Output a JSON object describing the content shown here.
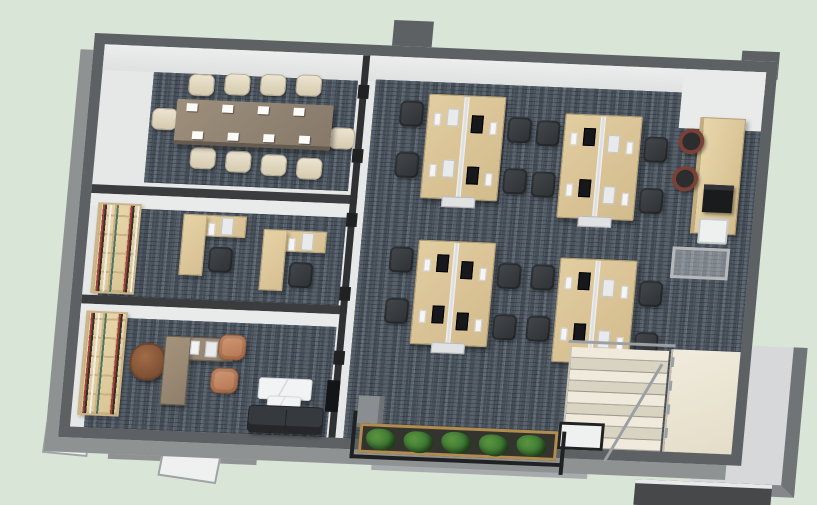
{
  "app": {
    "type": "3d-floorplan-render",
    "view": "axonometric top-down",
    "subject": "office interior with meeting room, private offices, open workspace, pantry and stairwell"
  },
  "colors": {
    "background": "#d9e5d7",
    "wallCap": "#5e6163",
    "wallOuter": "#8f9293",
    "wallDark": "#3a3c3e",
    "floorWhite": "#e6e7e7",
    "faceWhite": "#eceeee",
    "carpet": "#4d5660",
    "wood": "#e0cba0",
    "woodDeep": "#cbb488",
    "tableWalnut": "#93846f",
    "cream": "#e7dfcb",
    "chairDark": "#3a3d41",
    "monitorDark": "#17181c",
    "monitorLight": "#e8eaeb",
    "execBrown": "#8a5a3d",
    "guestTan": "#c48a66",
    "sofa": "#36393d",
    "marble": "#f2f3f4",
    "stoolTop": "#2b2d2f",
    "stoolRing": "#7b4036",
    "plantGreen": "#3e7a33",
    "soil": "#33342e",
    "planterWood": "#b28b4e",
    "tileBeige": "#ebe5d3",
    "stepLight": "#efeadb",
    "stepShade": "#d9d3c2",
    "railMetal": "#9aa0a4",
    "frameBlack": "#1f2123",
    "glassWhite": "#eff1f0",
    "parapetGray": "#a8abad",
    "ledgeTan": "#cdbf9f"
  },
  "scene": {
    "rooms": [
      {
        "id": "conference-room",
        "label": "Conference room",
        "items": [
          "walnut conference table",
          "10 cream upholstered chairs",
          "8 white notepads"
        ]
      },
      {
        "id": "shared-office",
        "label": "Shared office",
        "items": [
          "bookshelf wall",
          "2 L-shaped wood desks",
          "2 monitors",
          "2 dark task chairs"
        ]
      },
      {
        "id": "executive-office",
        "label": "Executive office",
        "items": [
          "bookshelf wall",
          "L-shaped desk with computer",
          "brown leather executive chair",
          "2 tan guest chairs",
          "white marble coffee table",
          "charcoal sofa"
        ]
      },
      {
        "id": "open-office",
        "label": "Open office",
        "items": [
          "4 bench desk clusters",
          "16 monitors",
          "16 keyboards",
          "16 dark task chairs"
        ]
      },
      {
        "id": "pantry",
        "label": "Pantry counter",
        "items": [
          "tall wood counter",
          "2 bar stools",
          "coffee machine",
          "white appliance",
          "metal console table"
        ]
      },
      {
        "id": "stairwell",
        "label": "Stairwell",
        "items": [
          "stone staircase",
          "metal railing",
          "beige tile landing"
        ]
      },
      {
        "id": "south-edge",
        "label": "South terrace edge",
        "items": [
          "planter with 5 shrubs",
          "black framed glass balustrade",
          "gray parapet",
          "concrete pillar"
        ]
      }
    ],
    "counts": {
      "desk_clusters": 4,
      "open_office_workstations": 16,
      "conference_seats": 10,
      "bar_stools": 2,
      "planter_shrubs": 5,
      "private_offices": 2
    }
  }
}
